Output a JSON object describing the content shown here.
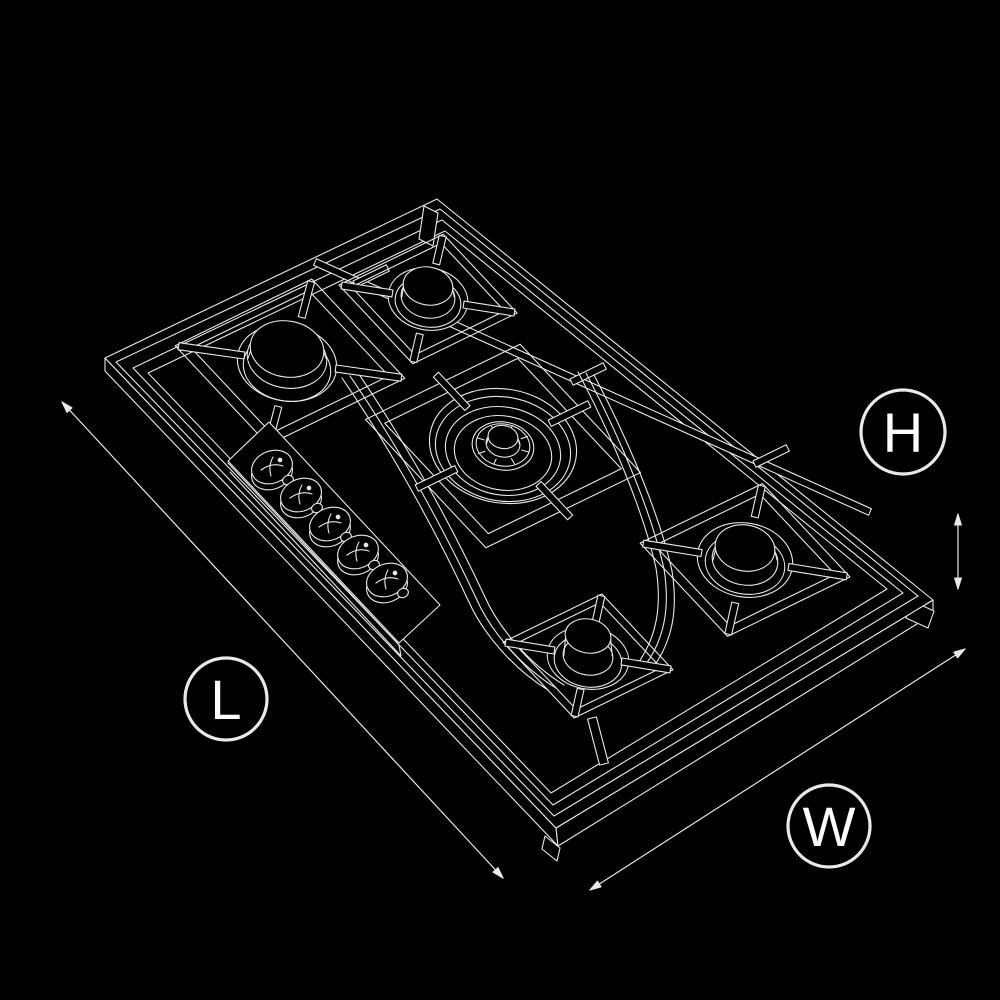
{
  "figure": {
    "subject": "five-burner gas cooktop wireframe line drawing",
    "burner_count": 5,
    "control_knob_count": 5
  },
  "labels": {
    "length": "L",
    "width": "W",
    "height": "H"
  },
  "colors": {
    "background": "#000000",
    "line": "#e9e9e9",
    "label_text": "#ffffff"
  }
}
